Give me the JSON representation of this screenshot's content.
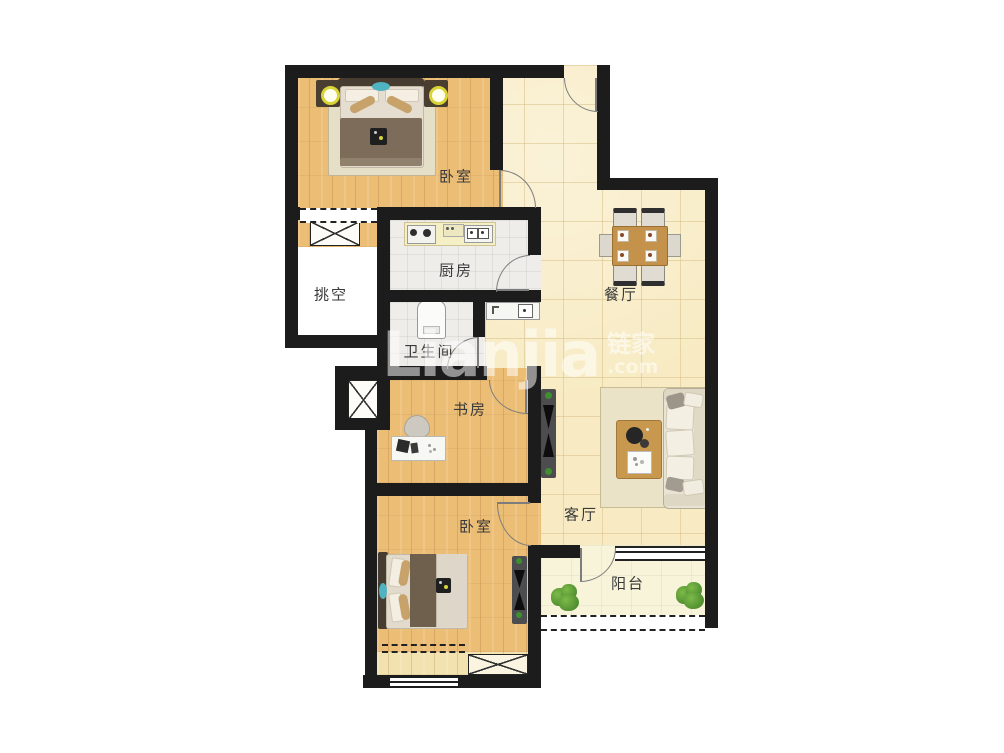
{
  "rooms": {
    "bedroom_top": "卧室",
    "kitchen": "厨房",
    "dining": "餐厅",
    "void": "挑空",
    "bathroom": "卫生间",
    "study": "书房",
    "living": "客厅",
    "bedroom_bottom": "卧室",
    "balcony": "阳台"
  },
  "watermark": {
    "brand": "Lianjia",
    "brand_cjk": "链家",
    "suffix": ".com"
  },
  "colors": {
    "wall": "#1c1c1c",
    "wood_floor": "#ecbd75",
    "tile_floor": "#f8ebc3",
    "wet_tile": "#eeede9",
    "balcony_floor": "#f7f4da",
    "void_floor": "#ffffff",
    "table_wood": "#c5924c",
    "plant_green": "#4e9134",
    "lamp_yellow": "#d8d436",
    "teal_accent": "#4fb3c2"
  }
}
